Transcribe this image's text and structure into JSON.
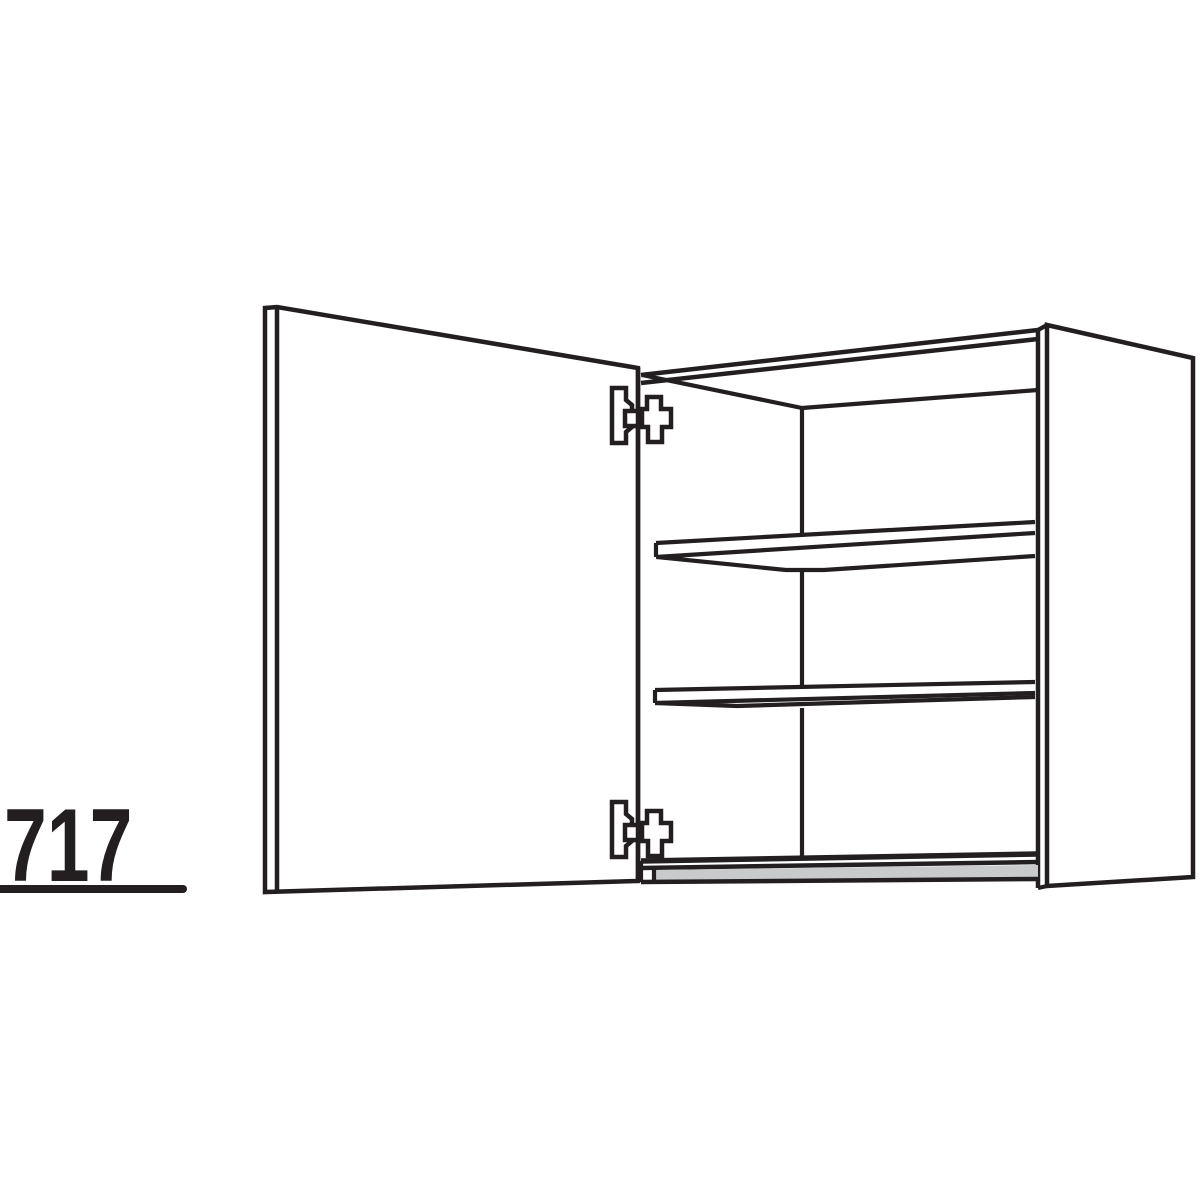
{
  "page": {
    "background": "#ffffff"
  },
  "diagram": {
    "kind": "furniture-line-drawing",
    "stroke_color": "#231f20",
    "panel_fill": "#ffffff",
    "bottom_panel_gray": "#c8cacc",
    "default_stroke_width": 4.2,
    "dimension_label": {
      "text": "717",
      "color": "#231f20"
    },
    "shapes": [
      {
        "name": "side-panel-outer-face",
        "type": "polygon",
        "points": [
          [
            1047,
            325
          ],
          [
            1193,
            358
          ],
          [
            1193,
            877
          ],
          [
            1047,
            886
          ]
        ],
        "fill": "#ffffff",
        "sw": 4.5
      },
      {
        "name": "top-right-corner-cap",
        "type": "line",
        "x1": 1038,
        "y1": 330,
        "x2": 1047,
        "y2": 325
      },
      {
        "name": "front-right-edge-inner",
        "type": "line",
        "x1": 1038,
        "y1": 330,
        "x2": 1038,
        "y2": 888,
        "sw": 4.5
      },
      {
        "name": "bottom-right-corner-cap",
        "type": "line",
        "x1": 1038,
        "y1": 888,
        "x2": 1047,
        "y2": 886
      },
      {
        "name": "top-front-edge-outer",
        "type": "line",
        "x1": 641,
        "y1": 375,
        "x2": 1038,
        "y2": 330,
        "sw": 4.5
      },
      {
        "name": "top-front-edge-inner",
        "type": "line",
        "x1": 641,
        "y1": 383,
        "x2": 1038,
        "y2": 339,
        "sw": 4.5
      },
      {
        "name": "interior-top-left-edge",
        "type": "line",
        "x1": 642,
        "y1": 375,
        "x2": 802,
        "y2": 408
      },
      {
        "name": "interior-top-back-edge",
        "type": "line",
        "x1": 802,
        "y1": 408,
        "x2": 1038,
        "y2": 390
      },
      {
        "name": "interior-back-corner-upper",
        "type": "line",
        "x1": 802,
        "y1": 408,
        "x2": 802,
        "y2": 533
      },
      {
        "name": "interior-back-corner-middle",
        "type": "line",
        "x1": 802,
        "y1": 572,
        "x2": 802,
        "y2": 685
      },
      {
        "name": "interior-back-corner-lower",
        "type": "line",
        "x1": 802,
        "y1": 708,
        "x2": 802,
        "y2": 856
      },
      {
        "name": "bottom-back-edge",
        "type": "line",
        "x1": 641,
        "y1": 861,
        "x2": 1038,
        "y2": 854,
        "sw": 5.5
      },
      {
        "name": "bottom-front-edge",
        "type": "line",
        "x1": 641,
        "y1": 868,
        "x2": 1038,
        "y2": 862,
        "sw": 4.5
      },
      {
        "name": "bottom-panel-front-face",
        "type": "polygon",
        "points": [
          [
            654,
            870
          ],
          [
            1038,
            865
          ],
          [
            1038,
            878
          ],
          [
            654,
            881
          ]
        ],
        "fill": "#c8cacc",
        "stroke": "none"
      },
      {
        "name": "bottom-lower-edge",
        "type": "line",
        "x1": 641,
        "y1": 882,
        "x2": 1038,
        "y2": 879,
        "sw": 4.5
      },
      {
        "name": "bottom-left-corner-edge",
        "type": "line",
        "x1": 641,
        "y1": 861,
        "x2": 641,
        "y2": 882
      },
      {
        "name": "bottom-left-end-cap",
        "type": "line",
        "x1": 654,
        "y1": 868,
        "x2": 654,
        "y2": 881
      },
      {
        "name": "shelf-upper-end-cap",
        "type": "line",
        "x1": 656,
        "y1": 543,
        "x2": 656,
        "y2": 557
      },
      {
        "name": "shelf-upper-top-edge",
        "type": "line",
        "x1": 656,
        "y1": 543,
        "x2": 1035,
        "y2": 522
      },
      {
        "name": "shelf-upper-front-edge",
        "type": "line",
        "x1": 656,
        "y1": 557,
        "x2": 1035,
        "y2": 533
      },
      {
        "name": "shelf-upper-bottom-edge",
        "type": "polyline",
        "points": [
          [
            657,
            557
          ],
          [
            786,
            570
          ],
          [
            824,
            570
          ],
          [
            1035,
            556
          ]
        ]
      },
      {
        "name": "shelf-lower-end-cap",
        "type": "line",
        "x1": 655,
        "y1": 690,
        "x2": 655,
        "y2": 703
      },
      {
        "name": "shelf-lower-top-edge",
        "type": "line",
        "x1": 655,
        "y1": 690,
        "x2": 1035,
        "y2": 682
      },
      {
        "name": "shelf-lower-front-edge",
        "type": "line",
        "x1": 655,
        "y1": 703,
        "x2": 1035,
        "y2": 693
      },
      {
        "name": "shelf-lower-bottom-edge",
        "type": "polyline",
        "points": [
          [
            655,
            703
          ],
          [
            737,
            706
          ],
          [
            1035,
            697
          ]
        ]
      },
      {
        "name": "door-panel",
        "type": "polygon",
        "points": [
          [
            265,
            308
          ],
          [
            277,
            307
          ],
          [
            638,
            368
          ],
          [
            638,
            881
          ],
          [
            265,
            892
          ]
        ],
        "fill": "#ffffff",
        "sw": 4.5
      },
      {
        "name": "hinge-top-mount-plate",
        "type": "path",
        "d": "M612,388 L626,388 L626,400 L632,405 L632,427 L626,432 L626,443 L612,443 Z",
        "fill": "#ffffff",
        "sw": 4.5
      },
      {
        "name": "hinge-top-stub",
        "type": "rect",
        "x": 625,
        "y": 411,
        "w": 18,
        "h": 15,
        "fill": "#ffffff",
        "sw": 4.5
      },
      {
        "name": "hinge-top-arm",
        "type": "path",
        "d": "M642,409 L647,409 L647,397 L661,397 L661,409 L671,409 L671,427 L662,427 L662,442 L648,442 L648,427 L642,427 Z",
        "fill": "#ffffff",
        "sw": 4.5
      },
      {
        "name": "hinge-bottom-mount-plate",
        "type": "path",
        "d": "M612,388 L626,388 L626,400 L632,405 L632,427 L626,432 L626,443 L612,443 Z",
        "fill": "#ffffff",
        "sw": 4.5,
        "translate": [
          0,
          414
        ]
      },
      {
        "name": "hinge-bottom-stub",
        "type": "rect",
        "x": 625,
        "y": 411,
        "w": 18,
        "h": 15,
        "fill": "#ffffff",
        "sw": 4.5,
        "translate": [
          0,
          414
        ]
      },
      {
        "name": "hinge-bottom-arm",
        "type": "path",
        "d": "M642,409 L647,409 L647,397 L661,397 L661,409 L671,409 L671,427 L662,427 L662,442 L648,442 L648,427 L642,427 Z",
        "fill": "#ffffff",
        "sw": 4.5,
        "translate": [
          0,
          414
        ]
      },
      {
        "name": "door-inner-edge",
        "type": "line",
        "x1": 277,
        "y1": 309,
        "x2": 277,
        "y2": 890,
        "sw": 4.5
      },
      {
        "name": "door-front-edge",
        "type": "line",
        "x1": 638,
        "y1": 368,
        "x2": 638,
        "y2": 881,
        "sw": 4.5
      },
      {
        "name": "dimension-underline",
        "type": "line",
        "x1": -6,
        "y1": 889,
        "x2": 183,
        "y2": 889,
        "sw": 8,
        "cap": "round"
      }
    ]
  }
}
